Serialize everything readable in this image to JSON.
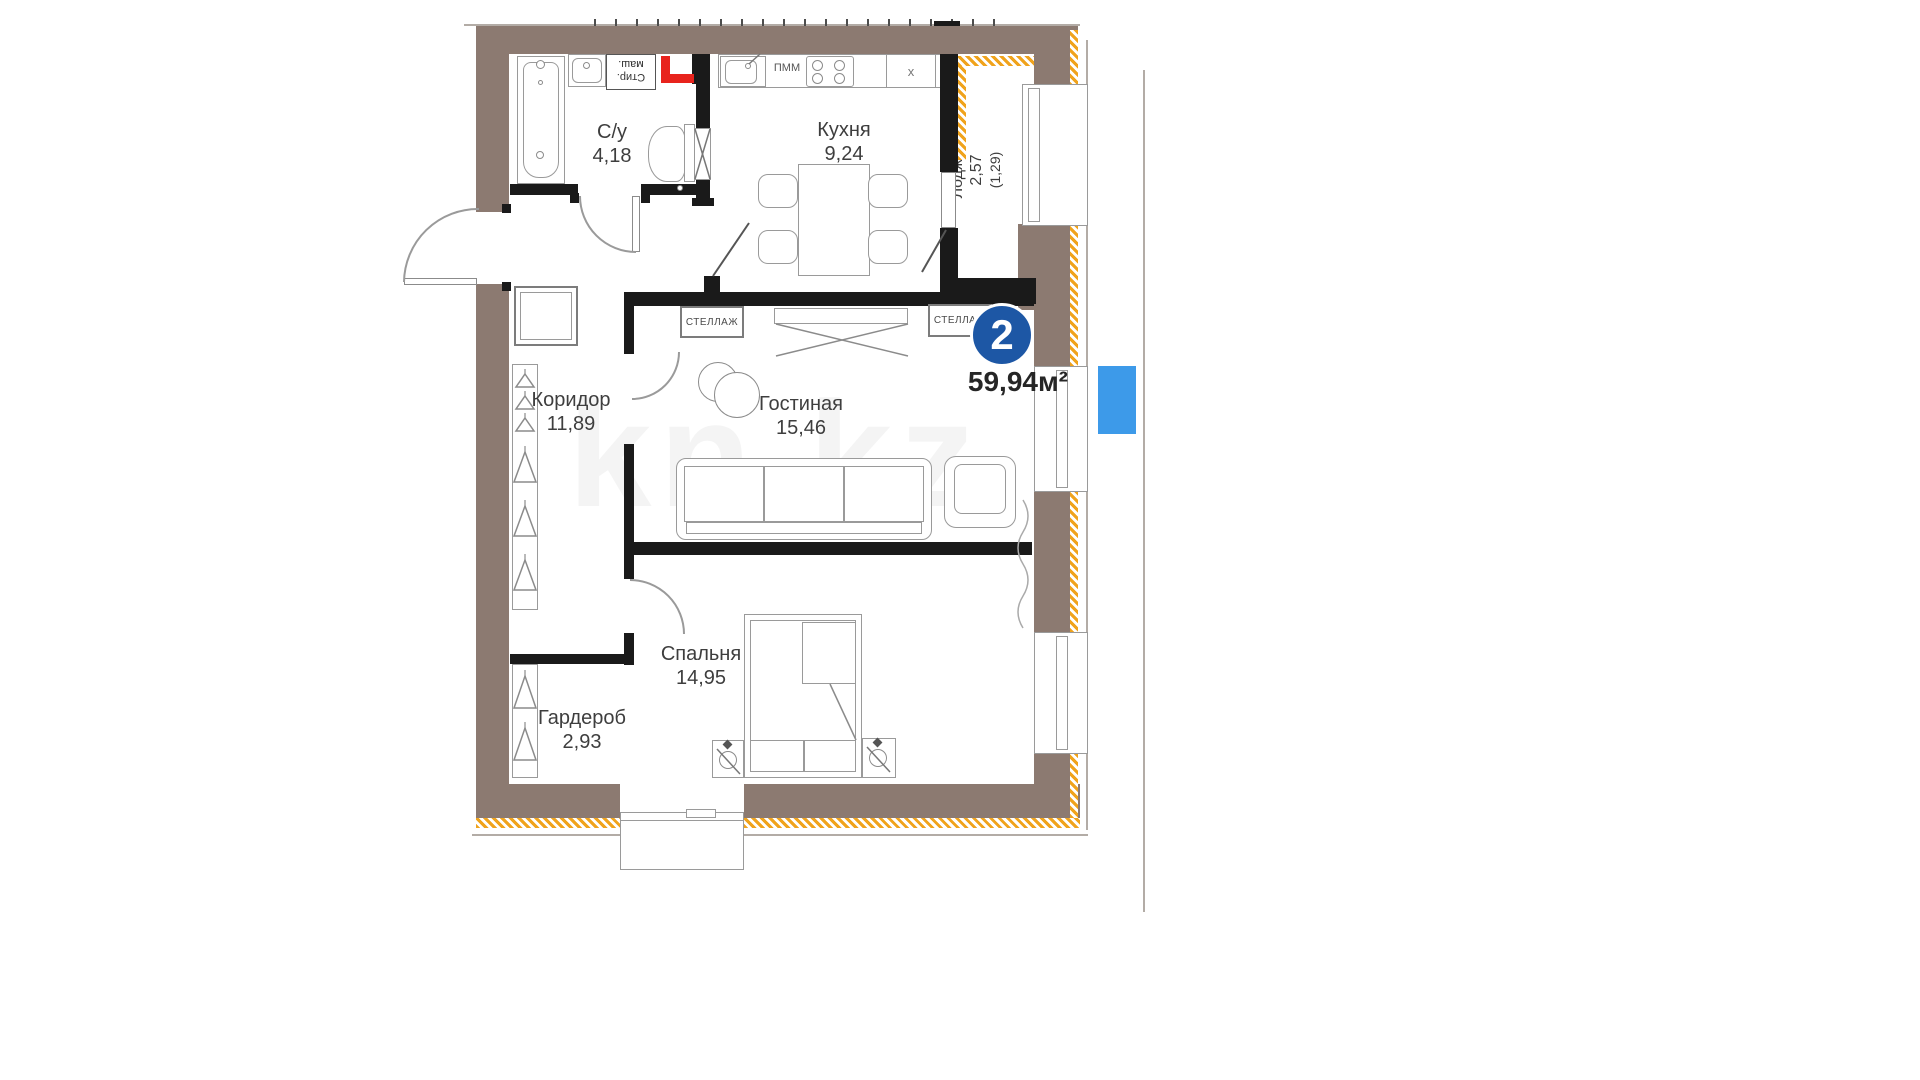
{
  "plan": {
    "badge": {
      "rooms_count": "2"
    },
    "area": {
      "total": "59,94м²"
    },
    "watermark": {
      "text": "kn.kz"
    },
    "rooms": [
      {
        "name": "С/у",
        "area": "4,18"
      },
      {
        "name": "Кухня",
        "area": "9,24"
      },
      {
        "name": "Лоджия",
        "area": "2,57",
        "area_reduced": "(1,29)"
      },
      {
        "name": "Коридор",
        "area": "11,89"
      },
      {
        "name": "Гостиная",
        "area": "15,46"
      },
      {
        "name": "Спальня",
        "area": "14,95"
      },
      {
        "name": "Гардероб",
        "area": "2,93"
      }
    ],
    "fixtures": {
      "shelf": "СТЕЛЛАЖ",
      "dishwasher": "ПММ",
      "washer_line1": "Стир.",
      "washer_line2": "маш.",
      "vent": "x"
    },
    "colors": {
      "outer_wall": "#8c7a71",
      "insulation": "#f0a31c",
      "interior_wall": "#1a1a1a",
      "highlight_red": "#e8231d",
      "badge_blue": "#1d57a5",
      "marker_blue": "#3d9ae9"
    }
  }
}
